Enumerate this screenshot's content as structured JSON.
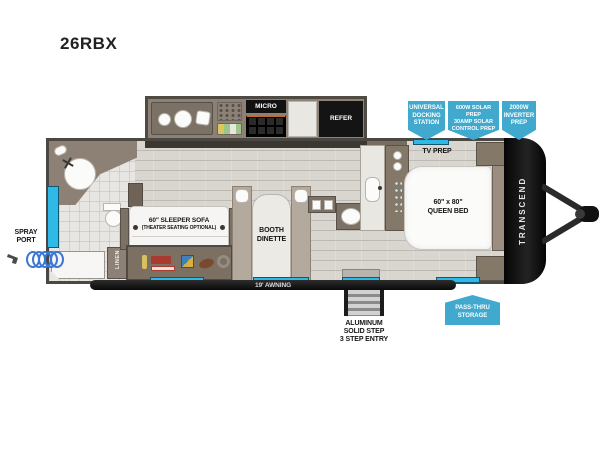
{
  "model": "26RBX",
  "brand": "TRANSCEND",
  "colors": {
    "accent": "#41A9CD",
    "window": "#2FB9E6",
    "wall": "#4B4743",
    "cabinet": "#8D8175",
    "floor": "#D9D5CF",
    "black": "#141414"
  },
  "callouts": {
    "docking": {
      "lines": [
        "UNIVERSAL",
        "DOCKING",
        "STATION"
      ]
    },
    "solar": {
      "lines": [
        "600W SOLAR PREP",
        "30AMP SOLAR",
        "CONTROL PREP"
      ]
    },
    "inverter": {
      "lines": [
        "2000W",
        "INVERTER",
        "PREP"
      ]
    },
    "passthru": {
      "lines": [
        "PASS-THRU",
        "STORAGE"
      ]
    }
  },
  "labels": {
    "tv_prep": "TV PREP",
    "queen_bed_1": "60\" x 80\"",
    "queen_bed_2": "QUEEN BED",
    "pet_dish": "PET DISH",
    "trash_1": "PULL-OUT",
    "trash_2": "TRASH",
    "dinette_1": "BOOTH",
    "dinette_2": "DINETTE",
    "sofa_1": "60\" SLEEPER SOFA",
    "sofa_2": "(THEATER SEATING OPTIONAL)",
    "linen": "LINEN",
    "micro": "MICRO",
    "refer": "REFER",
    "awning": "19' AWNING",
    "steps_1": "ALUMINUM",
    "steps_2": "SOLID STEP",
    "steps_3": "3 STEP ENTRY",
    "spray_1": "SPRAY",
    "spray_2": "PORT"
  }
}
